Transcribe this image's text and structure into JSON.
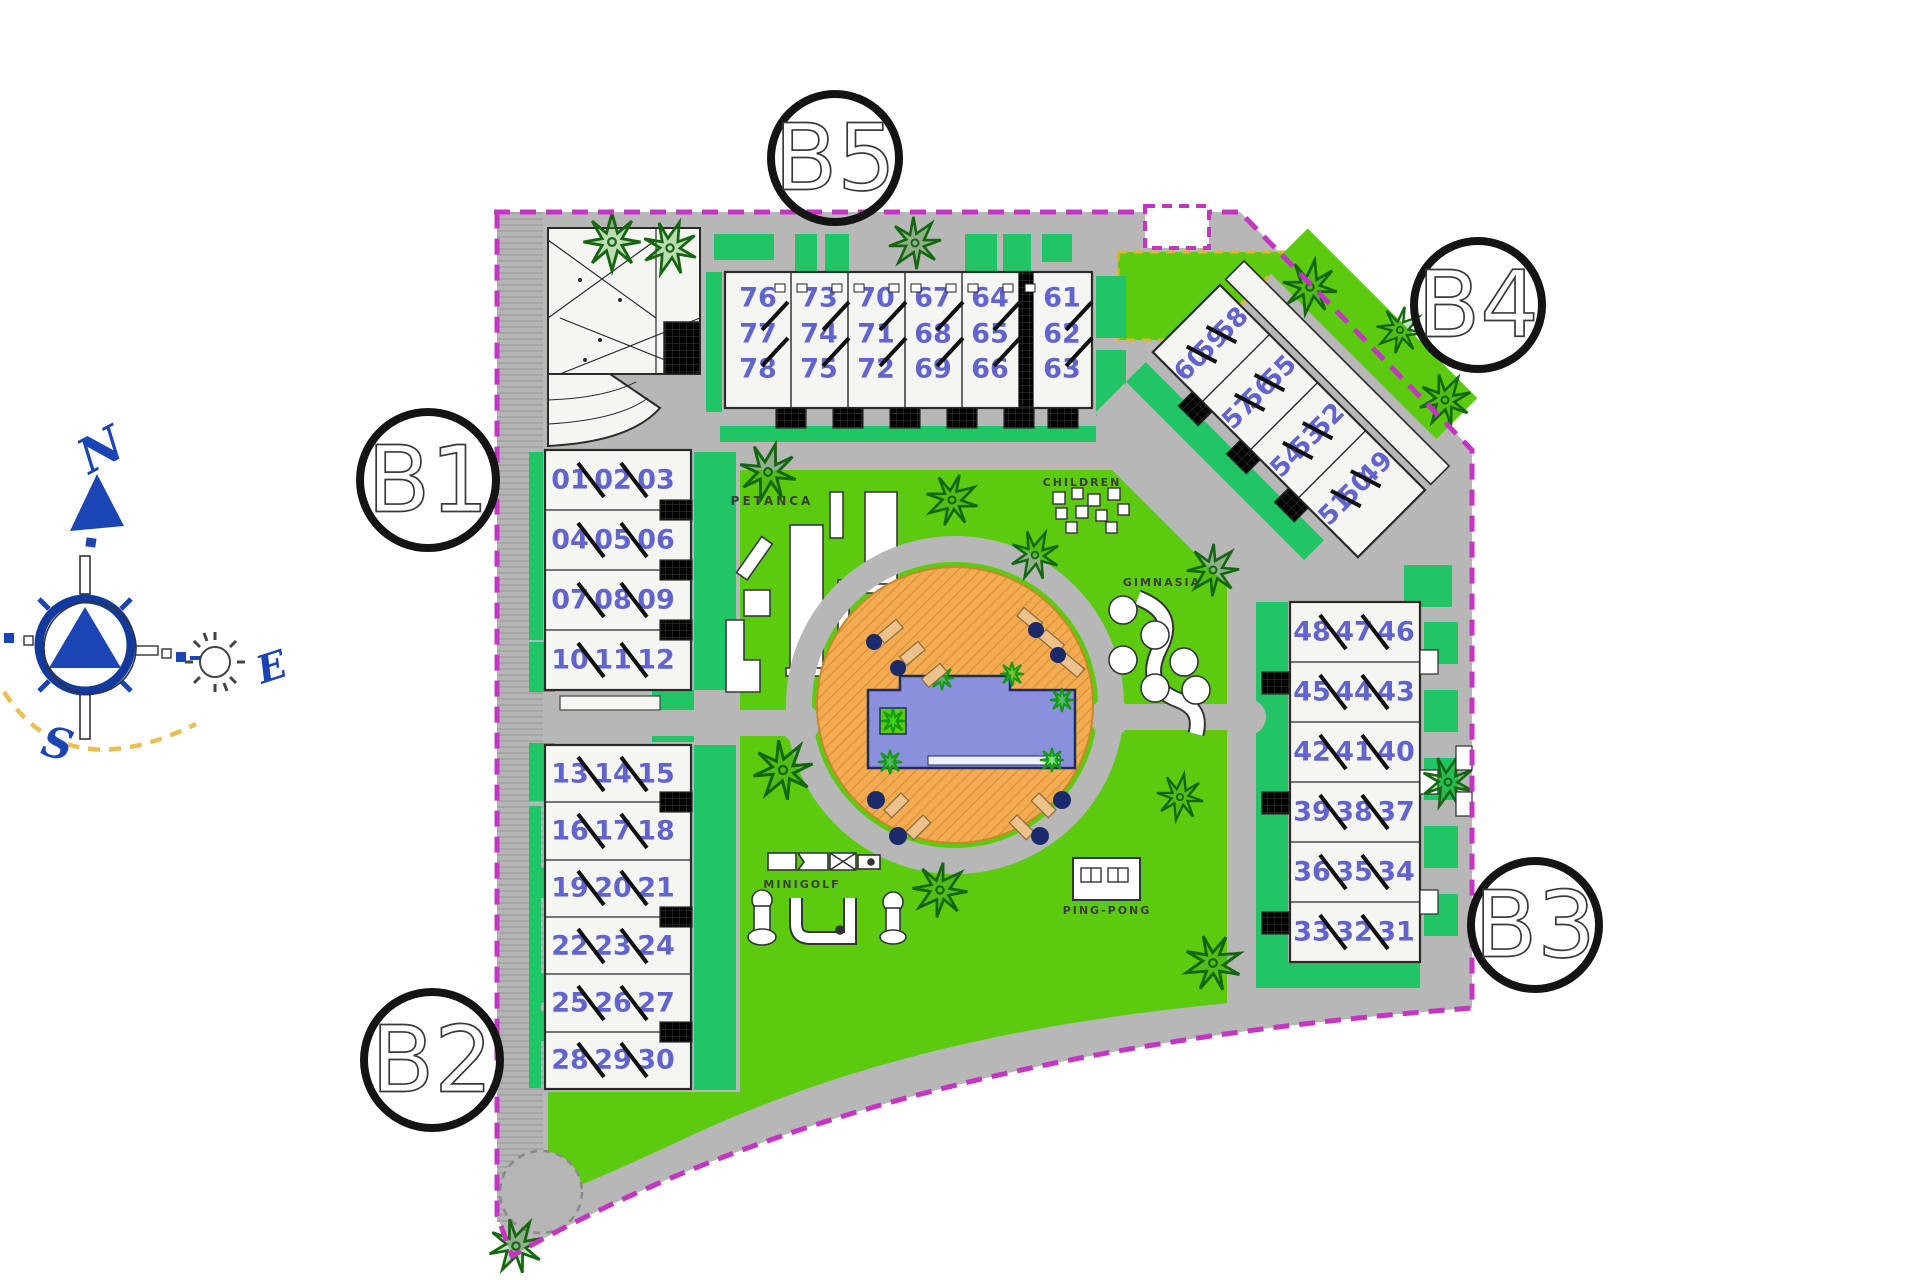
{
  "plan": {
    "markers": {
      "b1": "B1",
      "b2": "B2",
      "b3": "B3",
      "b4": "B4",
      "b5": "B5"
    },
    "amenities": {
      "petanca": "PETANCA",
      "children": "CHILDREN",
      "gimnasia": "GIMNASIA",
      "minigolf": "MINIGOLF",
      "pingpong": "PING-PONG"
    },
    "buildings": {
      "b5": {
        "columns": [
          [
            "76",
            "77",
            "78"
          ],
          [
            "73",
            "74",
            "75"
          ],
          [
            "70",
            "71",
            "72"
          ],
          [
            "67",
            "68",
            "69"
          ],
          [
            "64",
            "65",
            "66"
          ],
          [
            "61",
            "62",
            "63"
          ]
        ]
      },
      "b4": {
        "rows": [
          [
            "60",
            "59",
            "58"
          ],
          [
            "57",
            "56",
            "55"
          ],
          [
            "54",
            "53",
            "52"
          ],
          [
            "51",
            "50",
            "49"
          ]
        ]
      },
      "b1": {
        "rows": [
          [
            "01",
            "02",
            "03"
          ],
          [
            "04",
            "05",
            "06"
          ],
          [
            "07",
            "08",
            "09"
          ],
          [
            "10",
            "11",
            "12"
          ]
        ]
      },
      "b2": {
        "rows": [
          [
            "13",
            "14",
            "15"
          ],
          [
            "16",
            "17",
            "18"
          ],
          [
            "19",
            "20",
            "21"
          ],
          [
            "22",
            "23",
            "24"
          ],
          [
            "25",
            "26",
            "27"
          ],
          [
            "28",
            "29",
            "30"
          ]
        ]
      },
      "b3": {
        "rows": [
          [
            "48",
            "47",
            "46"
          ],
          [
            "45",
            "44",
            "43"
          ],
          [
            "42",
            "41",
            "40"
          ],
          [
            "39",
            "38",
            "37"
          ],
          [
            "36",
            "35",
            "34"
          ],
          [
            "33",
            "32",
            "31"
          ]
        ]
      }
    },
    "compass": {
      "n": "N",
      "e": "E",
      "s": "S"
    },
    "colors": {
      "boundary": "#c435c4",
      "lawn": "#5ccb0f",
      "hedge": "#21c565",
      "road": "#b7b7b7",
      "building": "#f5f5f1",
      "unit_number": "#6164cf",
      "pool_water": "#8b90dd",
      "pool_deck": "#f2ab50",
      "tree": "#14660f",
      "compass_blue": "#1b45b4",
      "accent_yellow": "#e9be52"
    }
  }
}
